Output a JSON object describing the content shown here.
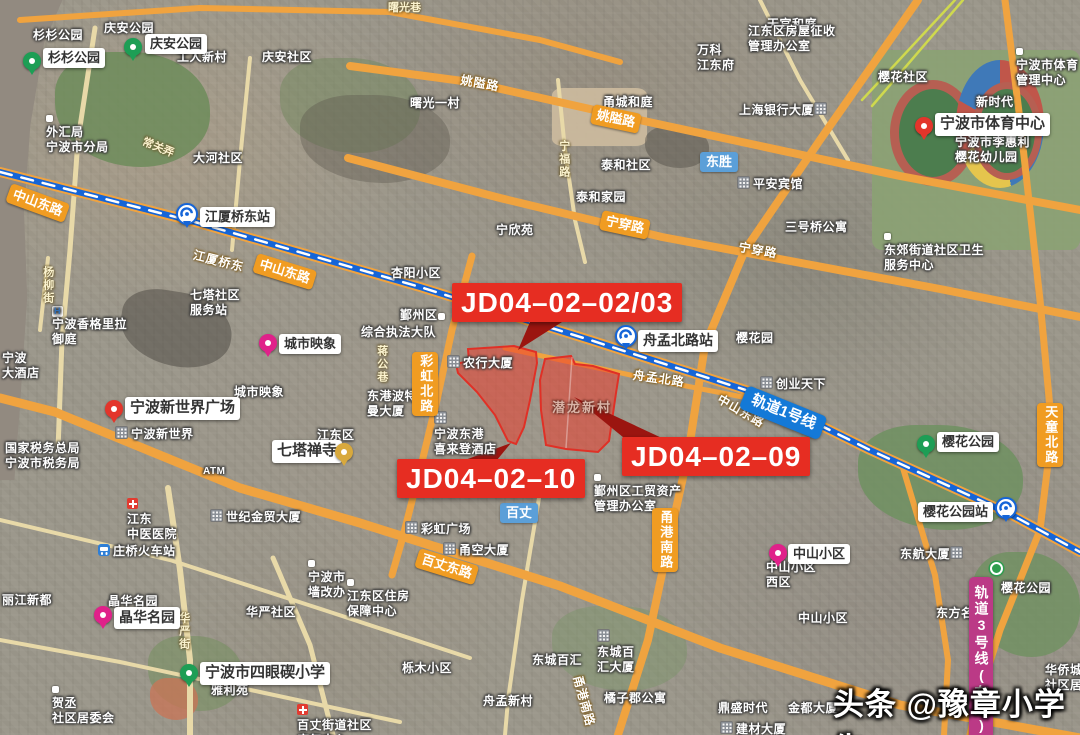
{
  "title": "宁波地块卫星图",
  "watermark": {
    "text": "头条 @豫章小学生"
  },
  "jd_labels": [
    {
      "name": "parcel-label-jd04-02-02-03",
      "text": "JD04–02–02/03",
      "x": 452,
      "y": 283
    },
    {
      "name": "parcel-label-jd04-02-10",
      "text": "JD04–02–10",
      "x": 397,
      "y": 459
    },
    {
      "name": "parcel-label-jd04-02-09",
      "text": "JD04–02–09",
      "x": 622,
      "y": 437
    }
  ],
  "parcels": [
    {
      "name": "parcel-jd04-02-02-03-10",
      "points": "456,364 469,361 468,349 514,346 536,352 537,363 530,400 524,427 516,444 508,441 495,415 477,392 458,373"
    },
    {
      "name": "parcel-jd04-02-09",
      "points": "545,359 571,356 575,364 593,366 619,374 616,393 609,441 598,452 566,449 546,445 541,410 540,380"
    }
  ],
  "colors": {
    "parcel_fill": "rgba(235,62,45,0.55)",
    "parcel_stroke": "#e03026",
    "wedge": "#9b1510",
    "road_major": "#f0a33f",
    "road_minor": "#e8d9a8",
    "rail1": "#1565d8",
    "rail3_badge": "#bb3a86"
  },
  "icon_glyphs": {
    "hotel": "H"
  },
  "labels": [
    {
      "n": "map-text-shanshan-park",
      "t": "area",
      "x": 33,
      "y": 28,
      "s": "杉杉公园"
    },
    {
      "n": "map-text-qingan-park",
      "t": "area",
      "x": 104,
      "y": 21,
      "s": "庆安公园"
    },
    {
      "n": "map-text-gongren-xincun",
      "t": "area",
      "x": 177,
      "y": 50,
      "s": "工人新村"
    },
    {
      "n": "map-text-qingan-shequ",
      "t": "area",
      "x": 262,
      "y": 50,
      "s": "庆安社区"
    },
    {
      "n": "map-text-dahe-shequ",
      "t": "area",
      "x": 193,
      "y": 151,
      "s": "大河社区"
    },
    {
      "n": "map-text-waihuiju",
      "t": "area",
      "x": 46,
      "y": 110,
      "lines": [
        "外汇局",
        "宁波市分局"
      ],
      "ic": "dot"
    },
    {
      "n": "lane-text-shuguangxiang",
      "t": "lane",
      "x": 388,
      "y": 2,
      "s": "曙光巷"
    },
    {
      "n": "map-text-shuguang-yicun",
      "t": "area",
      "x": 410,
      "y": 96,
      "s": "曙光一村"
    },
    {
      "n": "map-text-yongcheng-heting",
      "t": "area",
      "x": 603,
      "y": 95,
      "s": "甬城和庭"
    },
    {
      "n": "map-text-wanke-jiangdongfu",
      "t": "area",
      "x": 697,
      "y": 43,
      "lines": [
        "万科",
        "江东府"
      ]
    },
    {
      "n": "map-text-tianguan-heting",
      "t": "area",
      "x": 767,
      "y": 17,
      "s": "天官和庭"
    },
    {
      "n": "map-text-shanghai-bank",
      "t": "area",
      "x": 739,
      "y": 102,
      "s": "上海银行大厦",
      "ic": "building",
      "icAfter": true
    },
    {
      "n": "map-text-taihe-shequ",
      "t": "area",
      "x": 601,
      "y": 158,
      "s": "泰和社区"
    },
    {
      "n": "map-text-taihe-jiayuan",
      "t": "area",
      "x": 576,
      "y": 190,
      "s": "泰和家园"
    },
    {
      "n": "map-text-ningxinyuan",
      "t": "area",
      "x": 496,
      "y": 223,
      "s": "宁欣苑"
    },
    {
      "n": "map-text-pingan-hotel",
      "t": "area",
      "x": 737,
      "y": 176,
      "s": "平安宾馆",
      "ic": "building"
    },
    {
      "n": "map-text-sanhaoqiao",
      "t": "area",
      "x": 785,
      "y": 220,
      "s": "三号桥公寓"
    },
    {
      "n": "map-text-dongjiao-health",
      "t": "area",
      "x": 884,
      "y": 228,
      "lines": [
        "东郊街道社区卫生",
        "服务中心"
      ],
      "ic": "dot"
    },
    {
      "n": "map-text-sports-admin",
      "t": "area",
      "x": 1016,
      "y": 43,
      "lines": [
        "宁波市体育",
        "管理中心"
      ],
      "ic": "dot"
    },
    {
      "n": "map-text-yinghua-shequ",
      "t": "area",
      "x": 878,
      "y": 70,
      "s": "樱花社区"
    },
    {
      "n": "map-text-xinshidai",
      "t": "area",
      "x": 976,
      "y": 95,
      "s": "新时代"
    },
    {
      "n": "map-text-lihuili-kindergarten",
      "t": "area",
      "x": 955,
      "y": 119,
      "lines": [
        "宁波市李惠利",
        "樱花幼儿园"
      ],
      "ic": "building"
    },
    {
      "n": "map-text-fangwu-zhengshou",
      "t": "area",
      "x": 748,
      "y": 24,
      "lines": [
        "江东区房屋征收",
        "管理办公室"
      ]
    },
    {
      "n": "map-text-chuangye-tianxia",
      "t": "area",
      "x": 760,
      "y": 376,
      "s": "创业天下",
      "ic": "building"
    },
    {
      "n": "map-text-yinghuayuan",
      "t": "area",
      "x": 736,
      "y": 331,
      "s": "樱花园"
    },
    {
      "n": "map-text-qita-shequ",
      "t": "area",
      "x": 190,
      "y": 288,
      "lines": [
        "七塔社区",
        "服务站"
      ]
    },
    {
      "n": "map-text-shangri-la",
      "t": "area",
      "x": 52,
      "y": 302,
      "lines": [
        "宁波香格里拉",
        "御庭"
      ],
      "ic": "hotel"
    },
    {
      "n": "map-text-ningbo-hotel",
      "t": "area",
      "x": 2,
      "y": 351,
      "lines": [
        "宁波",
        "大酒店"
      ]
    },
    {
      "n": "map-text-chengshi-yingxiang",
      "t": "area",
      "x": 234,
      "y": 385,
      "s": "城市映象"
    },
    {
      "n": "map-text-new-world",
      "t": "area",
      "x": 115,
      "y": 426,
      "s": "宁波新世界",
      "ic": "building"
    },
    {
      "n": "map-text-shuiwuju",
      "t": "area",
      "x": 5,
      "y": 441,
      "lines": [
        "国家税务总局",
        "宁波市税务局"
      ]
    },
    {
      "n": "map-text-jiangdongqu",
      "t": "area",
      "x": 317,
      "y": 428,
      "s": "江东区"
    },
    {
      "n": "map-text-portman",
      "t": "area",
      "x": 367,
      "y": 389,
      "lines": [
        "东港波特",
        "曼大厦"
      ]
    },
    {
      "n": "map-text-sheraton",
      "t": "area",
      "x": 434,
      "y": 411,
      "lines": [
        "宁波东港",
        "喜来登酒店"
      ],
      "ic": "building"
    },
    {
      "n": "map-text-yinzhouqu",
      "t": "area",
      "x": 400,
      "y": 308,
      "s": "鄞州区",
      "ic": "dot",
      "icAfter": true
    },
    {
      "n": "map-text-zhifadadui",
      "t": "area",
      "x": 361,
      "y": 325,
      "s": "综合执法大队"
    },
    {
      "n": "map-text-xingyang-xiaoqu",
      "t": "area",
      "x": 391,
      "y": 266,
      "s": "杏阳小区"
    },
    {
      "n": "map-text-nonghang-dasha",
      "t": "area",
      "x": 447,
      "y": 355,
      "s": "农行大厦",
      "ic": "building"
    },
    {
      "n": "map-text-qianlong-xincun",
      "t": "parcelText",
      "x": 552,
      "y": 400,
      "s": "潜龙新村"
    },
    {
      "n": "road-text-zhoumeng-beilu",
      "t": "roadtext",
      "x": 634,
      "y": 368,
      "s": "舟孟北路",
      "r": 8
    },
    {
      "n": "road-text-jiangxiaqiaodong",
      "t": "roadtext",
      "x": 195,
      "y": 248,
      "s": "江厦桥东",
      "r": 14
    },
    {
      "n": "road-text-zhongshan-donglu",
      "t": "roadtext",
      "x": 722,
      "y": 392,
      "s": "中山东路",
      "r": 30
    },
    {
      "n": "road-text-ningchuan-lu",
      "t": "roadtext",
      "x": 740,
      "y": 240,
      "s": "宁穿路",
      "r": 10
    },
    {
      "n": "road-text-yaoai-lu",
      "t": "roadtext",
      "x": 462,
      "y": 73,
      "s": "姚隘路",
      "r": 10
    },
    {
      "n": "lane-text-ningfu-lu",
      "t": "lane",
      "x": 556,
      "y": 140,
      "s": "宁福路",
      "v": true
    },
    {
      "n": "lane-text-changguannong",
      "t": "lane",
      "x": 145,
      "y": 136,
      "s": "常关弄",
      "r": 22
    },
    {
      "n": "lane-text-yangliujie",
      "t": "lane",
      "x": 40,
      "y": 266,
      "s": "杨柳街",
      "v": true
    },
    {
      "n": "lane-text-jianggongxiang",
      "t": "lane",
      "x": 374,
      "y": 345,
      "s": "蒋公巷",
      "v": true
    },
    {
      "n": "map-text-caihong-plaza",
      "t": "area",
      "x": 405,
      "y": 521,
      "s": "彩虹广场",
      "ic": "building"
    },
    {
      "n": "map-text-yongkong-dasha",
      "t": "area",
      "x": 443,
      "y": 542,
      "s": "甬空大厦",
      "ic": "building"
    },
    {
      "n": "map-text-shiji-jinmao",
      "t": "area",
      "x": 210,
      "y": 509,
      "s": "世纪金贸大厦",
      "ic": "building"
    },
    {
      "n": "map-text-zhongyi-hospital",
      "t": "area",
      "x": 127,
      "y": 497,
      "lines": [
        "江东",
        "中医医院"
      ],
      "ic": "hospital"
    },
    {
      "n": "map-text-zhuangqiao-station",
      "t": "area",
      "x": 98,
      "y": 544,
      "s": "庄桥火车站",
      "ic": "train"
    },
    {
      "n": "map-text-lijiang-xindu",
      "t": "area",
      "x": 2,
      "y": 593,
      "s": "丽江新都"
    },
    {
      "n": "map-text-jinghua-mingyuan",
      "t": "area",
      "x": 108,
      "y": 594,
      "s": "晶华名园"
    },
    {
      "n": "map-text-huayan-shequ",
      "t": "area",
      "x": 246,
      "y": 605,
      "s": "华严社区"
    },
    {
      "n": "map-text-qianggaiban",
      "t": "area",
      "x": 308,
      "y": 555,
      "lines": [
        "宁波市",
        "墙改办"
      ],
      "ic": "dot"
    },
    {
      "n": "map-text-zhufang-baozhang",
      "t": "area",
      "x": 347,
      "y": 574,
      "lines": [
        "江东区住房",
        "保障中心"
      ],
      "ic": "dot"
    },
    {
      "n": "lane-text-huayanjie",
      "t": "lane",
      "x": 176,
      "y": 612,
      "s": "华严街",
      "v": true
    },
    {
      "n": "map-text-limu-xiaoqu",
      "t": "area",
      "x": 402,
      "y": 661,
      "s": "栎木小区"
    },
    {
      "n": "map-text-hecheng-juweihui",
      "t": "area",
      "x": 52,
      "y": 681,
      "lines": [
        "贺丞",
        "社区居委会"
      ],
      "ic": "dot"
    },
    {
      "n": "map-text-yaliyuan",
      "t": "area",
      "x": 211,
      "y": 683,
      "s": "雅利苑"
    },
    {
      "n": "map-text-baizhang-kangfu",
      "t": "area",
      "x": 297,
      "y": 703,
      "lines": [
        "百丈街道社区",
        "康复中心"
      ],
      "ic": "hospital"
    },
    {
      "n": "map-text-dongcheng-baihui",
      "t": "area",
      "x": 532,
      "y": 653,
      "s": "东城百汇"
    },
    {
      "n": "map-text-dongcheng-baihui-dasha",
      "t": "area",
      "x": 597,
      "y": 629,
      "lines": [
        "东城百",
        "汇大厦"
      ],
      "ic": "building"
    },
    {
      "n": "map-text-zhoumeng-xincun",
      "t": "area",
      "x": 483,
      "y": 694,
      "s": "舟孟新村"
    },
    {
      "n": "map-text-juzijun-gongyu",
      "t": "area",
      "x": 604,
      "y": 691,
      "s": "橘子郡公寓"
    },
    {
      "n": "map-text-gongmao-zichan",
      "t": "area",
      "x": 594,
      "y": 469,
      "lines": [
        "鄞州区工贸资产",
        "管理办公室"
      ],
      "ic": "dot"
    },
    {
      "n": "map-text-zhongshan-xiqu",
      "t": "area",
      "x": 766,
      "y": 560,
      "lines": [
        "中山小区",
        "西区"
      ]
    },
    {
      "n": "map-text-zhongshan-xiaoqu2",
      "t": "area",
      "x": 798,
      "y": 611,
      "s": "中山小区"
    },
    {
      "n": "map-text-donghang-dasha",
      "t": "area",
      "x": 900,
      "y": 546,
      "s": "东航大厦",
      "ic": "building",
      "icAfter": true
    },
    {
      "n": "map-text-dongfang-mingdu",
      "t": "area",
      "x": 936,
      "y": 606,
      "s": "东方名都"
    },
    {
      "n": "map-text-yinghua-gongyuan2",
      "t": "area",
      "x": 1001,
      "y": 581,
      "s": "樱花公园"
    },
    {
      "n": "map-text-huaqiaocheng",
      "t": "area",
      "x": 1045,
      "y": 663,
      "lines": [
        "华侨城",
        "社区居委会"
      ]
    },
    {
      "n": "map-text-dingsheng-shidai",
      "t": "area",
      "x": 718,
      "y": 701,
      "s": "鼎盛时代"
    },
    {
      "n": "map-text-jindu-dasha",
      "t": "area",
      "x": 788,
      "y": 701,
      "s": "金都大厦"
    },
    {
      "n": "map-text-jiancai-dasha",
      "t": "area",
      "x": 720,
      "y": 721,
      "s": "建材大厦",
      "ic": "building"
    },
    {
      "n": "map-text-atm",
      "t": "area",
      "x": 203,
      "y": 466,
      "s": "ATM",
      "fs": 10
    },
    {
      "n": "road-text-yonggang-nanlu",
      "t": "roadtext",
      "x": 584,
      "y": 674,
      "s": "甬港南路",
      "r": 75
    },
    {
      "n": "road-badge-zhongshan-donglu-1",
      "t": "roadbadge",
      "x": 12,
      "y": 183,
      "s": "中山东路",
      "r": 20
    },
    {
      "n": "road-badge-zhongshan-donglu-2",
      "t": "roadbadge",
      "x": 258,
      "y": 253,
      "s": "中山东路",
      "r": 17
    },
    {
      "n": "road-badge-yaoai-lu",
      "t": "roadbadge",
      "x": 594,
      "y": 104,
      "s": "姚隘路",
      "r": 12
    },
    {
      "n": "road-badge-ningchuan-lu",
      "t": "roadbadge",
      "x": 603,
      "y": 210,
      "s": "宁穿路",
      "r": 12
    },
    {
      "n": "road-badge-baizhang-donglu",
      "t": "roadbadge",
      "x": 420,
      "y": 548,
      "s": "百丈东路",
      "r": 17
    },
    {
      "n": "road-badge-caihong-beilu",
      "t": "roadbadge",
      "x": 412,
      "y": 352,
      "s": "彩虹北路",
      "v": true
    },
    {
      "n": "road-badge-yonggang-nanlu",
      "t": "roadbadge",
      "x": 652,
      "y": 508,
      "s": "甬港南路",
      "v": true
    },
    {
      "n": "road-badge-tiantong-beilu",
      "t": "roadbadge",
      "x": 1037,
      "y": 403,
      "s": "天童北路",
      "v": true
    },
    {
      "n": "station-badge-dongsheng",
      "t": "stationbadge",
      "x": 700,
      "y": 152,
      "s": "东胜"
    },
    {
      "n": "station-badge-baizhang",
      "t": "stationbadge",
      "x": 500,
      "y": 503,
      "s": "百丈"
    },
    {
      "n": "rail-badge-line1",
      "t": "railbadge",
      "x": 748,
      "y": 385,
      "s": "轨道1号线",
      "r": 22
    },
    {
      "n": "rail-badge-line3",
      "t": "rail3badge",
      "x": 969,
      "y": 577,
      "s": "轨道3号线(在建)",
      "v": true
    },
    {
      "n": "poi-label-shanshan-park",
      "t": "boxed",
      "x": 43,
      "y": 48,
      "s": "杉杉公园"
    },
    {
      "n": "poi-label-qingan-park",
      "t": "boxed",
      "x": 145,
      "y": 34,
      "s": "庆安公园"
    },
    {
      "n": "poi-label-jiangxiaqiaodong-station",
      "t": "boxed",
      "x": 200,
      "y": 207,
      "s": "江厦桥东站"
    },
    {
      "n": "poi-label-chengshi-yingxiang",
      "t": "boxed",
      "x": 279,
      "y": 334,
      "s": "城市映象"
    },
    {
      "n": "poi-label-new-world-plaza",
      "t": "boxed",
      "x": 125,
      "y": 397,
      "s": "宁波新世界广场",
      "fs": 15
    },
    {
      "n": "poi-label-qita-chansi",
      "t": "boxed",
      "x": 272,
      "y": 440,
      "s": "七塔禅寺",
      "fs": 15
    },
    {
      "n": "poi-label-zhoumeng-beilu-station",
      "t": "boxed",
      "x": 638,
      "y": 330,
      "s": "舟孟北路站",
      "fs": 14
    },
    {
      "n": "poi-label-sports-center",
      "t": "boxed",
      "x": 935,
      "y": 113,
      "s": "宁波市体育中心",
      "fs": 15
    },
    {
      "n": "poi-label-yinghua-park",
      "t": "boxed",
      "x": 937,
      "y": 432,
      "s": "樱花公园"
    },
    {
      "n": "poi-label-siyanqi-school",
      "t": "boxed",
      "x": 200,
      "y": 662,
      "s": "宁波市四眼碶小学",
      "fs": 15
    },
    {
      "n": "poi-label-jinghua-mingyuan",
      "t": "boxed",
      "x": 114,
      "y": 607,
      "s": "晶华名园",
      "fs": 14
    },
    {
      "n": "poi-label-zhongshan-xiaoqu",
      "t": "boxed",
      "x": 788,
      "y": 544,
      "s": "中山小区"
    },
    {
      "n": "poi-label-yinghua-park-station",
      "t": "boxed",
      "x": 918,
      "y": 502,
      "s": "樱花公园站"
    }
  ],
  "pins": [
    {
      "n": "pin-shanshan-park",
      "c": "green",
      "x": 32,
      "y": 76
    },
    {
      "n": "pin-qingan-park",
      "c": "green",
      "x": 133,
      "y": 62
    },
    {
      "n": "pin-chengshi-yingxiang",
      "c": "magenta",
      "x": 268,
      "y": 358
    },
    {
      "n": "pin-new-world-plaza",
      "c": "red",
      "x": 114,
      "y": 424
    },
    {
      "n": "pin-qita-chansi",
      "c": "yellow",
      "x": 344,
      "y": 467
    },
    {
      "n": "pin-sports-center",
      "c": "red",
      "x": 924,
      "y": 141
    },
    {
      "n": "pin-yinghua-park",
      "c": "green",
      "x": 926,
      "y": 459
    },
    {
      "n": "pin-siyanqi-school",
      "c": "green",
      "x": 189,
      "y": 688
    },
    {
      "n": "pin-jinghua-mingyuan",
      "c": "magenta",
      "x": 103,
      "y": 630
    },
    {
      "n": "pin-zhongshan-xiaoqu",
      "c": "magenta",
      "x": 778,
      "y": 568
    }
  ],
  "stations": [
    {
      "n": "metro-icon-jiangxiaqiaodong",
      "x": 187,
      "y": 217
    },
    {
      "n": "metro-icon-zhoumengbeilu",
      "x": 626,
      "y": 339
    },
    {
      "n": "metro-icon-yinghuagongyuan",
      "x": 1006,
      "y": 511
    }
  ],
  "misc_icons": [
    {
      "n": "metro-line3-roundel-icon",
      "x": 990,
      "y": 562
    }
  ]
}
